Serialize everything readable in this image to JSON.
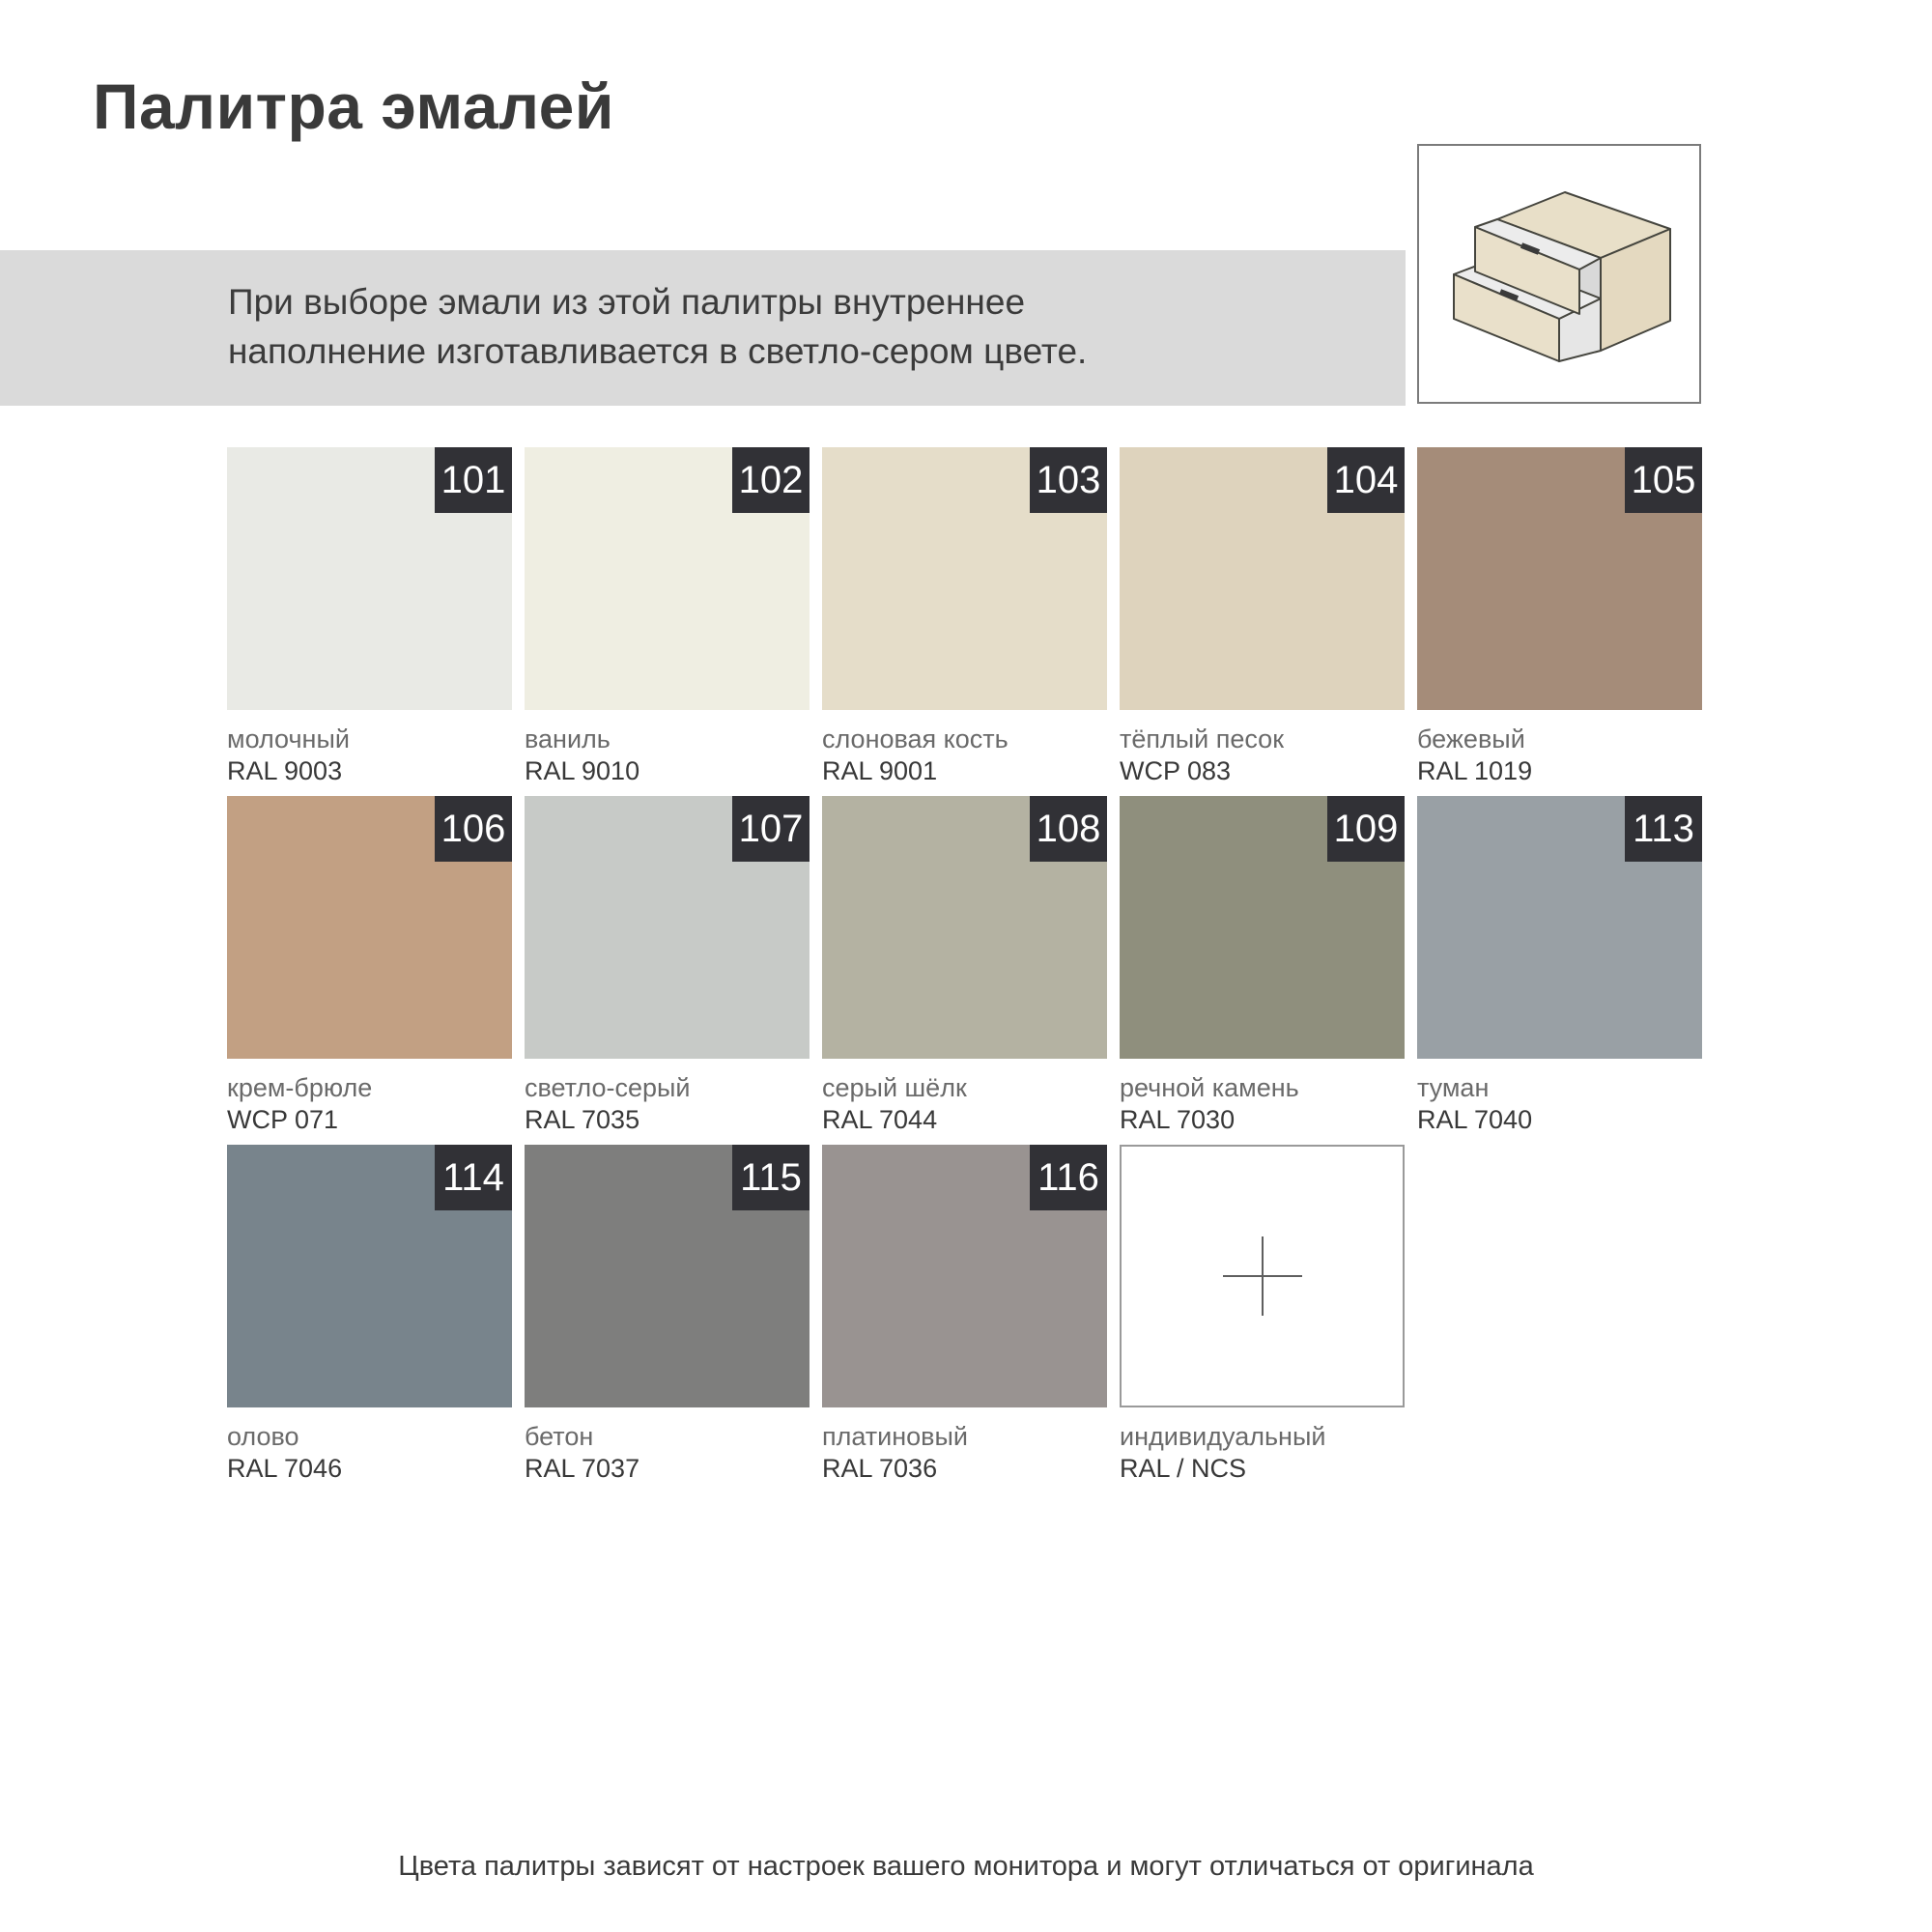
{
  "page": {
    "title": "Палитра эмалей",
    "footer": "Цвета палитры зависят от настроек вашего монитора и могут отличаться от оригинала"
  },
  "banner": {
    "line1": "При выборе эмали из этой палитры внутреннее",
    "line2": "наполнение изготавливается в светло-сером цвете.",
    "bg": "#dadada"
  },
  "icons": {
    "drawer_unit": "drawer-unit-illustration",
    "plus": "plus-crosshair"
  },
  "colors": {
    "badge_bg": "#313136",
    "badge_text": "#ffffff",
    "title_text": "#3a3a3a",
    "name_text": "#6a6a6a",
    "code_text": "#383838"
  },
  "swatches": [
    {
      "num": "101",
      "name": "молочный",
      "code": "RAL 9003",
      "hex": "#e9eae5"
    },
    {
      "num": "102",
      "name": "ваниль",
      "code": "RAL 9010",
      "hex": "#efeee2"
    },
    {
      "num": "103",
      "name": "слоновая кость",
      "code": "RAL 9001",
      "hex": "#e5ddc9"
    },
    {
      "num": "104",
      "name": "тёплый песок",
      "code": "WCP 083",
      "hex": "#ded3bd"
    },
    {
      "num": "105",
      "name": "бежевый",
      "code": "RAL 1019",
      "hex": "#a58c79"
    },
    {
      "num": "106",
      "name": "крем-брюле",
      "code": "WCP 071",
      "hex": "#c2a083"
    },
    {
      "num": "107",
      "name": "светло-серый",
      "code": "RAL 7035",
      "hex": "#c7cac7"
    },
    {
      "num": "108",
      "name": "серый шёлк",
      "code": "RAL 7044",
      "hex": "#b4b2a2"
    },
    {
      "num": "109",
      "name": "речной камень",
      "code": "RAL 7030",
      "hex": "#8f8f7d"
    },
    {
      "num": "113",
      "name": "туман",
      "code": "RAL 7040",
      "hex": "#99a0a5"
    },
    {
      "num": "114",
      "name": "олово",
      "code": "RAL 7046",
      "hex": "#78848c"
    },
    {
      "num": "115",
      "name": "бетон",
      "code": "RAL 7037",
      "hex": "#7e7e7d"
    },
    {
      "num": "116",
      "name": "платиновый",
      "code": "RAL 7036",
      "hex": "#999391"
    },
    {
      "num": "",
      "name": "индивидуальный",
      "code": "RAL / NCS",
      "hex": "#ffffff",
      "custom": true
    }
  ]
}
